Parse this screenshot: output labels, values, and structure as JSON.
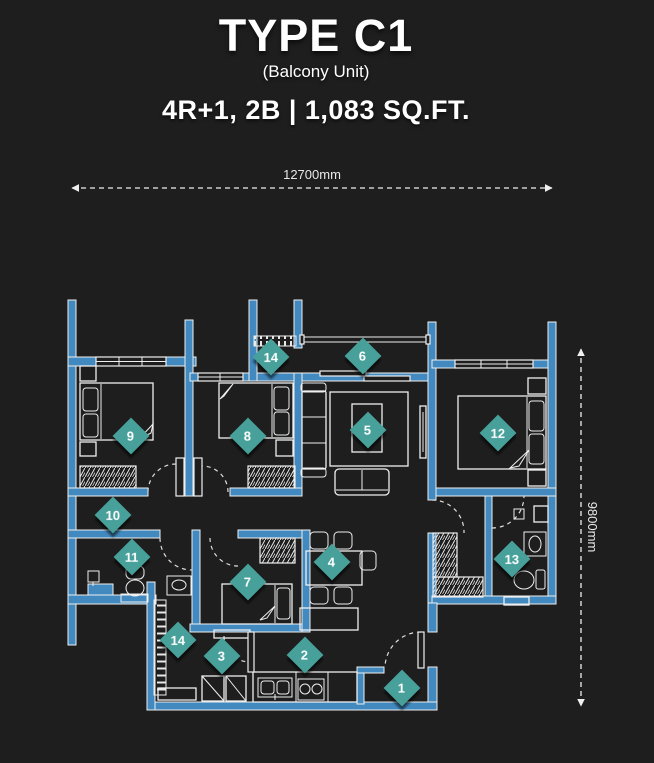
{
  "header": {
    "title": "TYPE C1",
    "subtitle": "(Balcony Unit)",
    "specs": "4R+1, 2B | 1,083 SQ.FT."
  },
  "dimensions": {
    "width_label": "12700mm",
    "height_label": "9800mm"
  },
  "markers": [
    {
      "label": "1",
      "x": 402,
      "y": 688
    },
    {
      "label": "2",
      "x": 305,
      "y": 655
    },
    {
      "label": "3",
      "x": 222,
      "y": 656
    },
    {
      "label": "4",
      "x": 332,
      "y": 562
    },
    {
      "label": "5",
      "x": 368,
      "y": 430
    },
    {
      "label": "6",
      "x": 363,
      "y": 356
    },
    {
      "label": "7",
      "x": 248,
      "y": 582
    },
    {
      "label": "8",
      "x": 248,
      "y": 436
    },
    {
      "label": "9",
      "x": 131,
      "y": 436
    },
    {
      "label": "10",
      "x": 113,
      "y": 515
    },
    {
      "label": "11",
      "x": 132,
      "y": 557
    },
    {
      "label": "12",
      "x": 498,
      "y": 433
    },
    {
      "label": "13",
      "x": 512,
      "y": 559
    },
    {
      "label": "14",
      "x": 271,
      "y": 357
    },
    {
      "label": "14",
      "x": 178,
      "y": 640
    }
  ],
  "colors": {
    "background": "#1e1e1e",
    "wall": "#4189be",
    "marker": "#47a09a",
    "line": "#efefef"
  }
}
